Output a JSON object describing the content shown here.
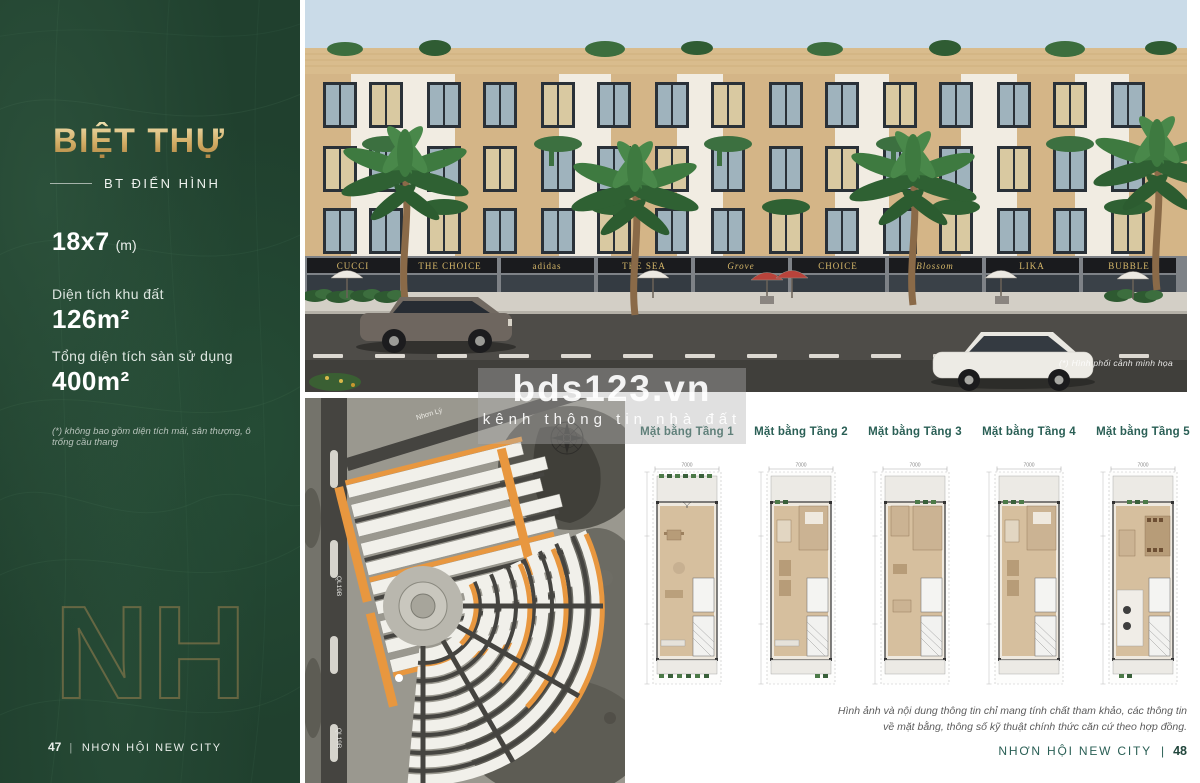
{
  "sidebar": {
    "title": "BIỆT THỰ",
    "subtitle": "BT ĐIỂN HÌNH",
    "size": "18x7",
    "size_unit": "(m)",
    "land_area": {
      "label": "Diện tích khu đất",
      "value": "126m²"
    },
    "floor_area": {
      "label": "Tổng diện tích sàn sử dụng",
      "value": "400m²"
    },
    "footnote": "(*) không bao gồm diện tích mái, sân thượng, ô trống cầu thang",
    "monogram": "NH",
    "footer": {
      "page": "47",
      "separator": "|",
      "text": "NHƠN HỘI NEW CITY"
    }
  },
  "render": {
    "caption": "(*) Hình phối cảnh minh họa",
    "shop_signs": [
      "CUCCI",
      "THE CHOICE",
      "adidas",
      "THE SEA",
      "Grove",
      "CHOICE",
      "Blossom",
      "LIKA",
      "BUBBLE"
    ]
  },
  "watermark": {
    "title": "bds123.vn",
    "tagline": "kênh thông tin nhà đất"
  },
  "masterplan": {
    "road_top": "Nhơn Lý",
    "road_left": "QL19B"
  },
  "floorplans": {
    "tabs": [
      "Mặt bằng Tầng 1",
      "Mặt bằng Tầng 2",
      "Mặt bằng Tầng 3",
      "Mặt bằng Tầng 4",
      "Mặt bằng Tầng 5"
    ],
    "width_dimension": "7000"
  },
  "footer": {
    "disclaimer_line1": "Hình ảnh và nội dung thông tin chỉ mang tính chất tham khảo, các thông tin",
    "disclaimer_line2": "về mặt bằng, thông số kỹ thuật chính thức căn cứ theo hợp đồng.",
    "brand": "NHƠN HỘI NEW CITY",
    "separator": "|",
    "page": "48"
  },
  "colors": {
    "sidebar_green": "#20402e",
    "gold": "#cda964",
    "teal": "#2a5f55",
    "masterplan_highlight": "#e8973f"
  }
}
